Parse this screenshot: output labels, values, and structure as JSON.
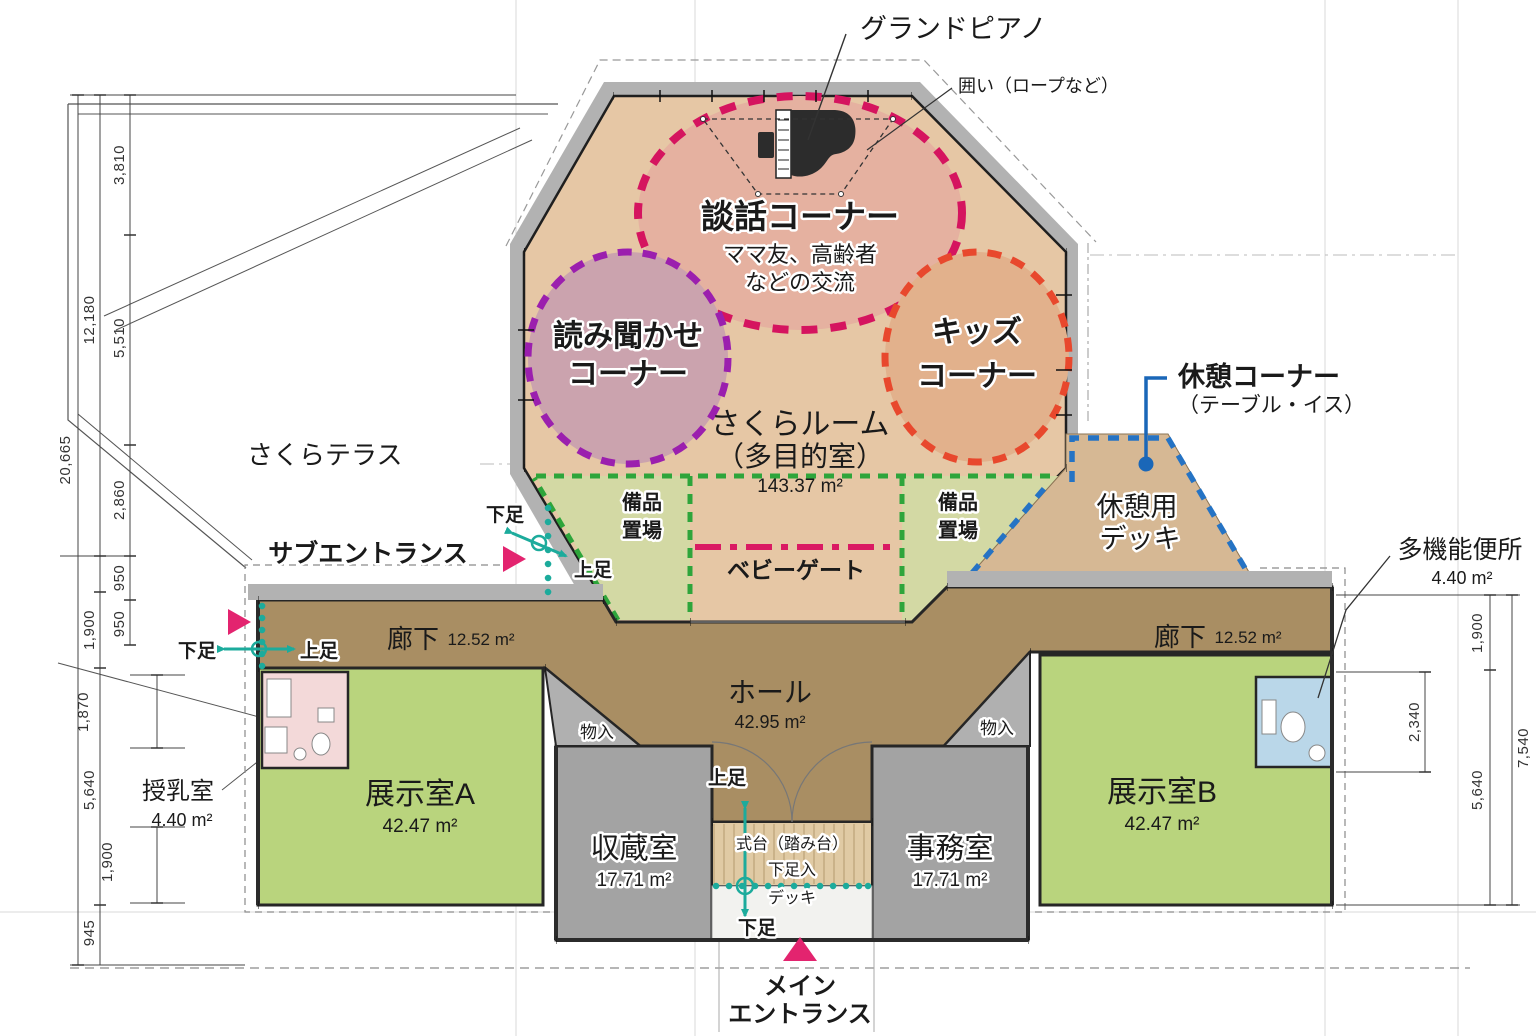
{
  "colors": {
    "crimson": "#da1a63",
    "pink_arrow": "#e3246f",
    "teal": "#1cab9c",
    "blue": "#1a67b8",
    "purple": "#9b1fae",
    "orange": "#e8482d",
    "green": "#2ea53b",
    "floor_tan": "#e6c7a5",
    "corridor_brown": "#a98e63",
    "room_green": "#b9d47d",
    "room_gray": "#a3a3a3",
    "closet_gray": "#b0b0b0",
    "nursing_pink": "#f3d9d9",
    "toilet_blue": "#bad7e9",
    "deck_tan": "#d6b894",
    "equip_green": "#d3d9a4",
    "eaves_gray": "#b2b2b2",
    "danwa_fill": "#e5b1a0",
    "yomi_fill": "#cba3ae",
    "kids_fill": "#e2b18c",
    "wood": "#e0caa4"
  },
  "annotations": {
    "grand_piano": "グランドピアノ",
    "enclosure": "囲い（ロープなど）",
    "rest_corner_line1": "休憩コーナー",
    "rest_corner_line2": "（テーブル・イス）",
    "toilet_name": "多機能便所",
    "toilet_area": "4.40 m²",
    "terrace": "さくらテラス",
    "sub_entrance": "サブエントランス",
    "main_entrance_line1": "メイン",
    "main_entrance_line2": "エントランス",
    "baby_gate": "ベビーゲート",
    "shoes_off": "下足",
    "shoes_on": "上足"
  },
  "zones": {
    "danwa_title": "談話コーナー",
    "danwa_sub1": "ママ友、高齢者",
    "danwa_sub2": "などの交流",
    "yomikikase_line1": "読み聞かせ",
    "yomikikase_line2": "コーナー",
    "kids_line1": "キッズ",
    "kids_line2": "コーナー",
    "equipment_line1": "備品",
    "equipment_line2": "置場"
  },
  "rooms": {
    "sakura_line1": "さくらルーム",
    "sakura_line2": "（多目的室）",
    "sakura_area": "143.37 m²",
    "rest_deck_line1": "休憩用",
    "rest_deck_line2": "デッキ",
    "corridor": "廊下",
    "corridor_area": "12.52 m²",
    "hall": "ホール",
    "hall_area": "42.95 m²",
    "exhibit_a": "展示室A",
    "exhibit_b": "展示室B",
    "exhibit_area": "42.47 m²",
    "storage": "収蔵室",
    "storage_area": "17.71 m²",
    "office": "事務室",
    "office_area": "17.71 m²",
    "nursing": "授乳室",
    "nursing_area": "4.40 m²",
    "closet": "物入",
    "shikidai": "式台（踏み台）",
    "shoe_cabinet": "下足入",
    "small_deck": "デッキ"
  },
  "dimensions": {
    "left": [
      "3,810",
      "12,180",
      "5,510",
      "20,665",
      "2,860",
      "950",
      "1,900",
      "950",
      "1,870",
      "5,640",
      "1,900",
      "945"
    ],
    "right": [
      "1,900",
      "2,340",
      "7,540",
      "5,640"
    ]
  }
}
